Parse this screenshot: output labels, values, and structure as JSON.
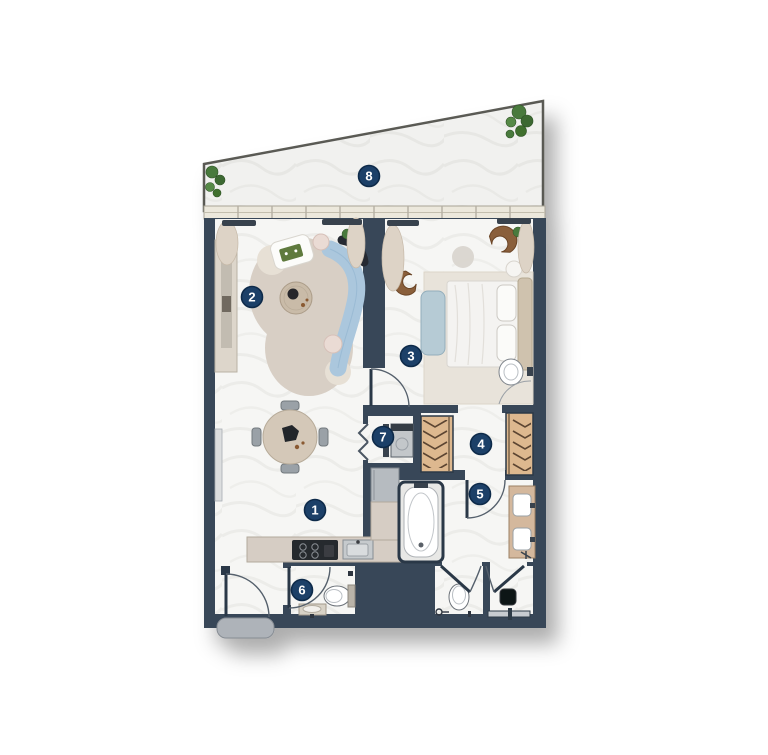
{
  "plan": {
    "type": "apartment-floor-plan",
    "badges": [
      {
        "label": "1"
      },
      {
        "label": "2"
      },
      {
        "label": "3"
      },
      {
        "label": "4"
      },
      {
        "label": "5"
      },
      {
        "label": "6"
      },
      {
        "label": "7"
      },
      {
        "label": "8"
      }
    ],
    "colors": {
      "wall": "#394758",
      "wall_dark": "#2c3947",
      "floor_marble": "#f6f6f4",
      "terrace_border": "#5b5b55",
      "window_band": "#ece8dc",
      "badge_fill": "#1e4067",
      "badge_ring": "#0e2a4a",
      "badge_text": "#ffffff",
      "sofa_blue": "#abc7dd",
      "rug_beige": "#d8cfc5",
      "closet_tan": "#ddb88f",
      "hanger_brown": "#5b4430",
      "counter_beige": "#d6cdc4",
      "chair_brown": "#8a5e3a",
      "plant_green": "#4a7a3e"
    }
  }
}
